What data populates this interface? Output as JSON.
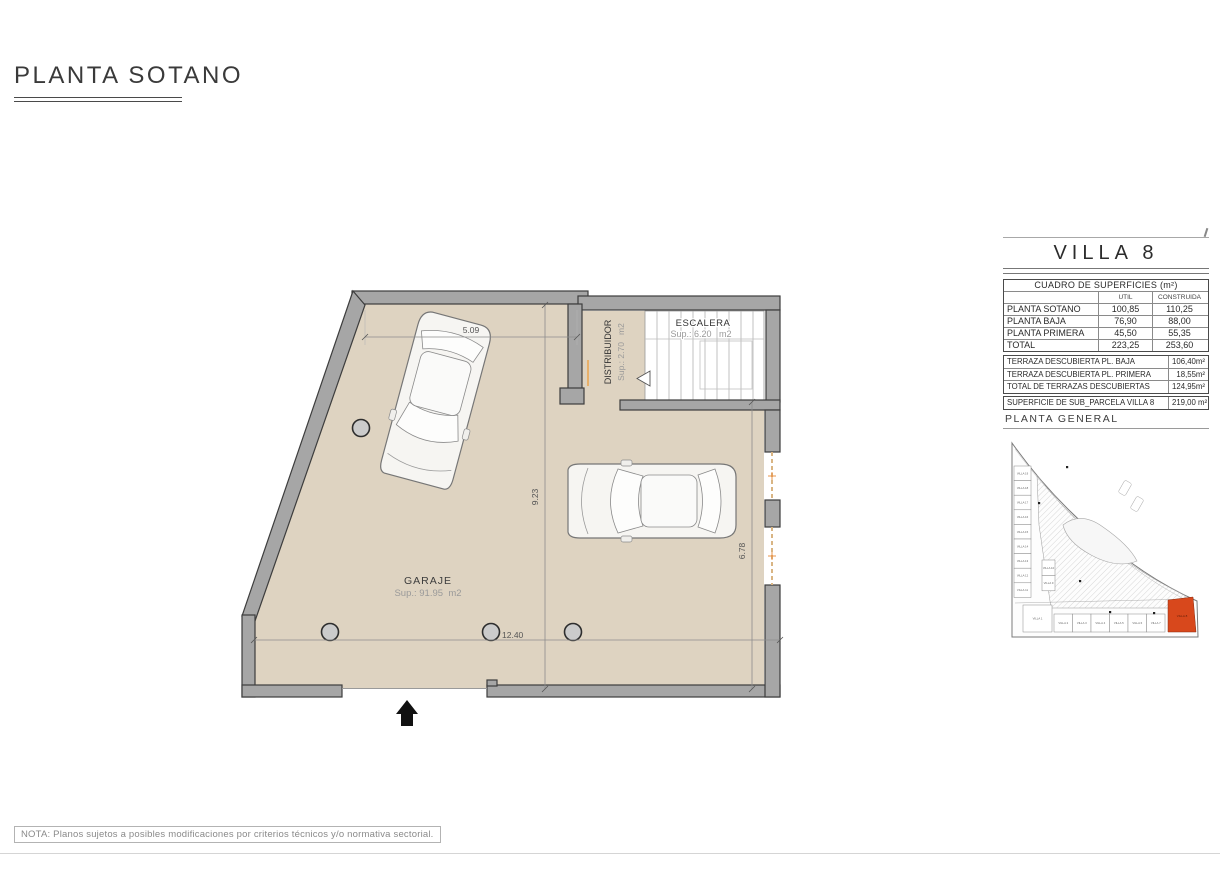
{
  "page": {
    "title": "PLANTA SOTANO",
    "footer_note": "NOTA: Planos sujetos a posibles modificaciones por criterios técnicos y/o normativa sectorial."
  },
  "plan": {
    "garage": {
      "name": "GARAJE",
      "area": "Sup.: 91.95  m2"
    },
    "stairs": {
      "name": "ESCALERA",
      "area": "Sup.: 6.20   m2"
    },
    "hall": {
      "name": "DISTRIBUIDOR",
      "area": "Sup.: 2.70   m2"
    },
    "dims": {
      "top": "5.09",
      "height": "9.23",
      "width": "12.40",
      "right": "6.78"
    }
  },
  "panel": {
    "villa_title": "VILLA 8",
    "surfaces": {
      "title": "CUADRO DE SUPERFICIES (m²)",
      "col_util": "UTIL",
      "col_construida": "CONSTRUIDA",
      "rows": [
        {
          "label": "PLANTA SOTANO",
          "util": "100,85",
          "construida": "110,25"
        },
        {
          "label": "PLANTA BAJA",
          "util": "76,90",
          "construida": "88,00"
        },
        {
          "label": "PLANTA PRIMERA",
          "util": "45,50",
          "construida": "55,35"
        },
        {
          "label": "TOTAL",
          "util": "223,25",
          "construida": "253,60"
        }
      ]
    },
    "terraces": {
      "rows": [
        {
          "label": "TERRAZA DESCUBIERTA PL. BAJA",
          "value": "106,40m²"
        },
        {
          "label": "TERRAZA DESCUBIERTA PL. PRIMERA",
          "value": "18,55m²"
        },
        {
          "label": "TOTAL DE TERRAZAS DESCUBIERTAS",
          "value": "124,95m²"
        }
      ]
    },
    "parcel": {
      "label": "SUPERFICIE DE SUB_PARCELA VILLA 8",
      "value": "219,00 m²"
    },
    "site_title": "PLANTA GENERAL",
    "minimap": {
      "left_units": [
        "VILLA 19",
        "VILLA 18",
        "VILLA 17",
        "VILLA 16",
        "VILLA 15",
        "VILLA 14",
        "VILLA 13",
        "VILLA 12",
        "VILLA 11"
      ],
      "middle_units": [
        "VILLA 10",
        "VILLA 9"
      ],
      "corner_unit": "VILLA 1",
      "bottom_units": [
        "VILLA 2",
        "VILLA 3",
        "VILLA 4",
        "VILLA 5",
        "VILLA 6",
        "VILLA 7"
      ],
      "highlight_unit": "VILLA 8"
    }
  },
  "colors": {
    "floor": "#ded3c1",
    "wall": "#a6a6a6",
    "wall_outline": "#3d3d3d",
    "accent_orange": "#e8a45e",
    "highlight": "#d8481c"
  }
}
